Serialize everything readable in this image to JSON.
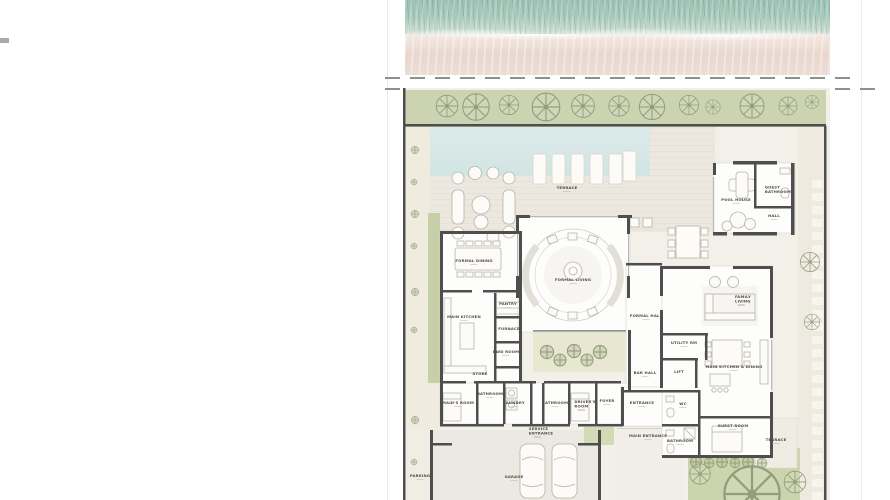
{
  "labels": {
    "outdoor": {
      "terrace_top": "TERRACE",
      "terrace_right": "TERRACE",
      "main_entrance": "MAIN ENTRANCE",
      "service_entrance": "SERVICE ENTRANCE",
      "parking": "PARKING",
      "garage": "GARAGE"
    },
    "pool_house": {
      "pool_house": "POOL HOUSE",
      "guest_bathroom": "GUEST BATHROOM",
      "hall": "HALL"
    },
    "rooms": {
      "formal_dining": "FORMAL DINING",
      "formal_living": "FORMAL LIVING",
      "formal_hall": "FORMAL HALL",
      "bar_hall": "BAR HALL",
      "main_kitchen": "MAIN KITCHEN",
      "pantry": "PANTRY",
      "furnace": "FURNACE",
      "pwd_room": "PWD ROOM",
      "store": "STORE",
      "family_living": "FAMILY LIVING",
      "utility_rm": "UTILITY RM",
      "lift": "LIFT",
      "main_kitchen_dining": "MAIN KITCHEN & DINING",
      "wc": "WC",
      "entrance": "ENTRANCE",
      "bathroom_hall": "BATHROOM",
      "guest_room": "GUEST ROOM",
      "maids_room": "MAID'S ROOM",
      "bathroom_1": "BATHROOM",
      "laundry": "LAUNDRY",
      "bathroom_2": "BATHROOM",
      "drivers_room": "DRIVER'S ROOM",
      "foyer": "FOYER"
    }
  },
  "colors": {
    "water": "#a4c9bc",
    "sand": "#e9d8cf",
    "site": "#f2f0e8",
    "landscape": "#ccd3b1",
    "pool": "#d7e8e6",
    "deck": "#ece7df",
    "wall": "#4e4e4e",
    "room": "#fdfdfb",
    "label_text": "#4f4c45"
  }
}
